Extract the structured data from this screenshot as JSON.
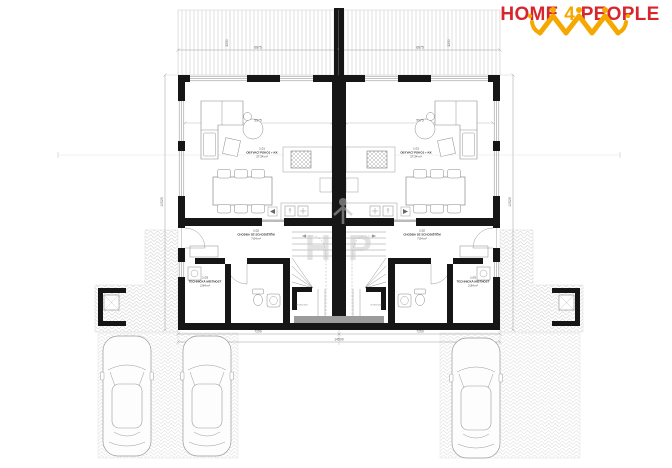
{
  "brand": {
    "home": "HOME",
    "four": "4",
    "people": "PEOPLE"
  },
  "watermark": {
    "left_letter": "H",
    "right_letter": "P"
  },
  "rooms": {
    "living": {
      "num": "1.01",
      "name": "OBÝVACÍ POKOJ + KK",
      "area": "27,34 m²"
    },
    "hall": {
      "num": "1.02",
      "name": "CHODBA SE SCHODIŠTĚM",
      "area": "7,04 m²"
    },
    "tech": {
      "num": "1.03",
      "name": "TECHNICKÁ MÍSTNOST",
      "area": "2,94 m²"
    },
    "stair_note": "9×184×250"
  },
  "dims": {
    "top": "6875",
    "terrace": "3250",
    "living_width": "5975",
    "side_height": "10525",
    "bottom_half": "7250",
    "bottom_total": "14500"
  }
}
